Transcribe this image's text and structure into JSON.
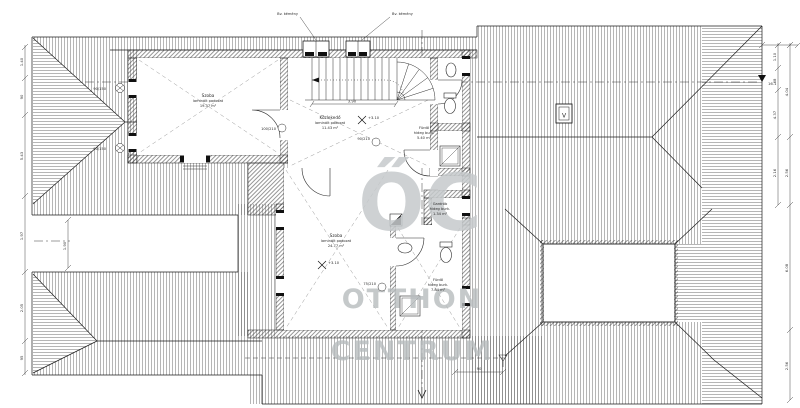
{
  "watermark": {
    "monogram": "ŐC",
    "word1": "OTTHON",
    "word2": "CENTRUM"
  },
  "rooms": {
    "szoba1": {
      "name": "Szoba",
      "floor": "laminált padozat",
      "area": "19.37 m²"
    },
    "kozlekedo": {
      "name": "Közlekedő",
      "floor": "laminált padozat",
      "area": "11.43 m²"
    },
    "szoba2": {
      "name": "Szoba",
      "floor": "laminált padozat",
      "area": "24.77 m²"
    },
    "furdo_felso": {
      "name": "Fürdő",
      "floor": "hideg burk.",
      "area": "5.40 m²"
    },
    "gardrob": {
      "name": "Gardrób",
      "floor": "hideg burk.",
      "area": "1.34 m²"
    },
    "furdo_also": {
      "name": "Fürdő",
      "floor": "hideg burk.",
      "area": "7.84 m²"
    }
  },
  "annotations": {
    "chimney_left": "Bv. kémény",
    "chimney_right": "Bv. kémény",
    "level_upper": "+3.10",
    "level_lower": "+3.10",
    "ridge_level": "16.1",
    "skylight": "V",
    "door_tag_1": "100/210",
    "door_tag_2": "90/210",
    "door_tag_3": "75/210",
    "window_tag_1": "90/150",
    "window_tag_2": "90/150",
    "stair_dim": "3.90",
    "bottom_dim": "90"
  },
  "dimensions": {
    "left": [
      "1.40",
      "90",
      "5.43",
      "1.97",
      "2.05",
      "95"
    ],
    "right_inner": [
      "1.10",
      "68",
      "4.37",
      "2.16"
    ],
    "right_outer": [
      "4.04",
      "2.56",
      "6.08",
      "2.56"
    ],
    "band": [
      "1.90"
    ]
  },
  "colors": {
    "line": "#1c1c1c",
    "hatch": "#6b6b6b",
    "watermark": "#b7bcbe"
  }
}
